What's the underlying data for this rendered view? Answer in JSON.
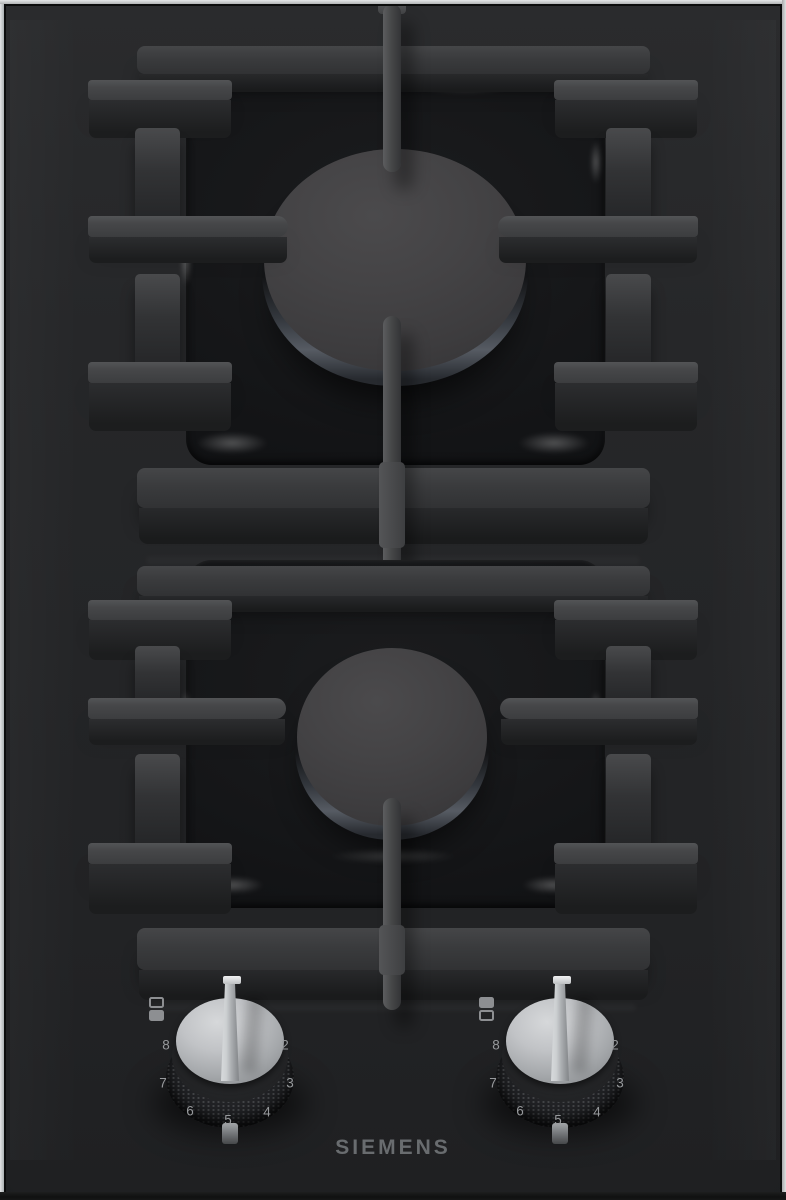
{
  "brand": {
    "logo_text": "SIEMENS"
  },
  "appearance": {
    "glass_color": "#242527",
    "frame_color": "#c9cacc",
    "grate_color": "#3e3f41",
    "cap_color": "#413f41",
    "knob_silver": "#b7b9bc",
    "scale_label_color": "#97999c",
    "logo_color": "#696c6f"
  },
  "burners": {
    "rear": {
      "name": "rear burner",
      "size": "large"
    },
    "front": {
      "name": "front burner",
      "size": "small"
    }
  },
  "controls": {
    "left_knob": {
      "handle_direction": "up",
      "indicator_icon": {
        "top_square": "outline",
        "bottom_square": "filled"
      },
      "scale_labels": [
        "8",
        "7",
        "6",
        "5",
        "4",
        "3",
        "2"
      ]
    },
    "right_knob": {
      "handle_direction": "up",
      "indicator_icon": {
        "top_square": "filled",
        "bottom_square": "outline"
      },
      "scale_labels": [
        "8",
        "7",
        "6",
        "5",
        "4",
        "3",
        "2"
      ]
    }
  }
}
